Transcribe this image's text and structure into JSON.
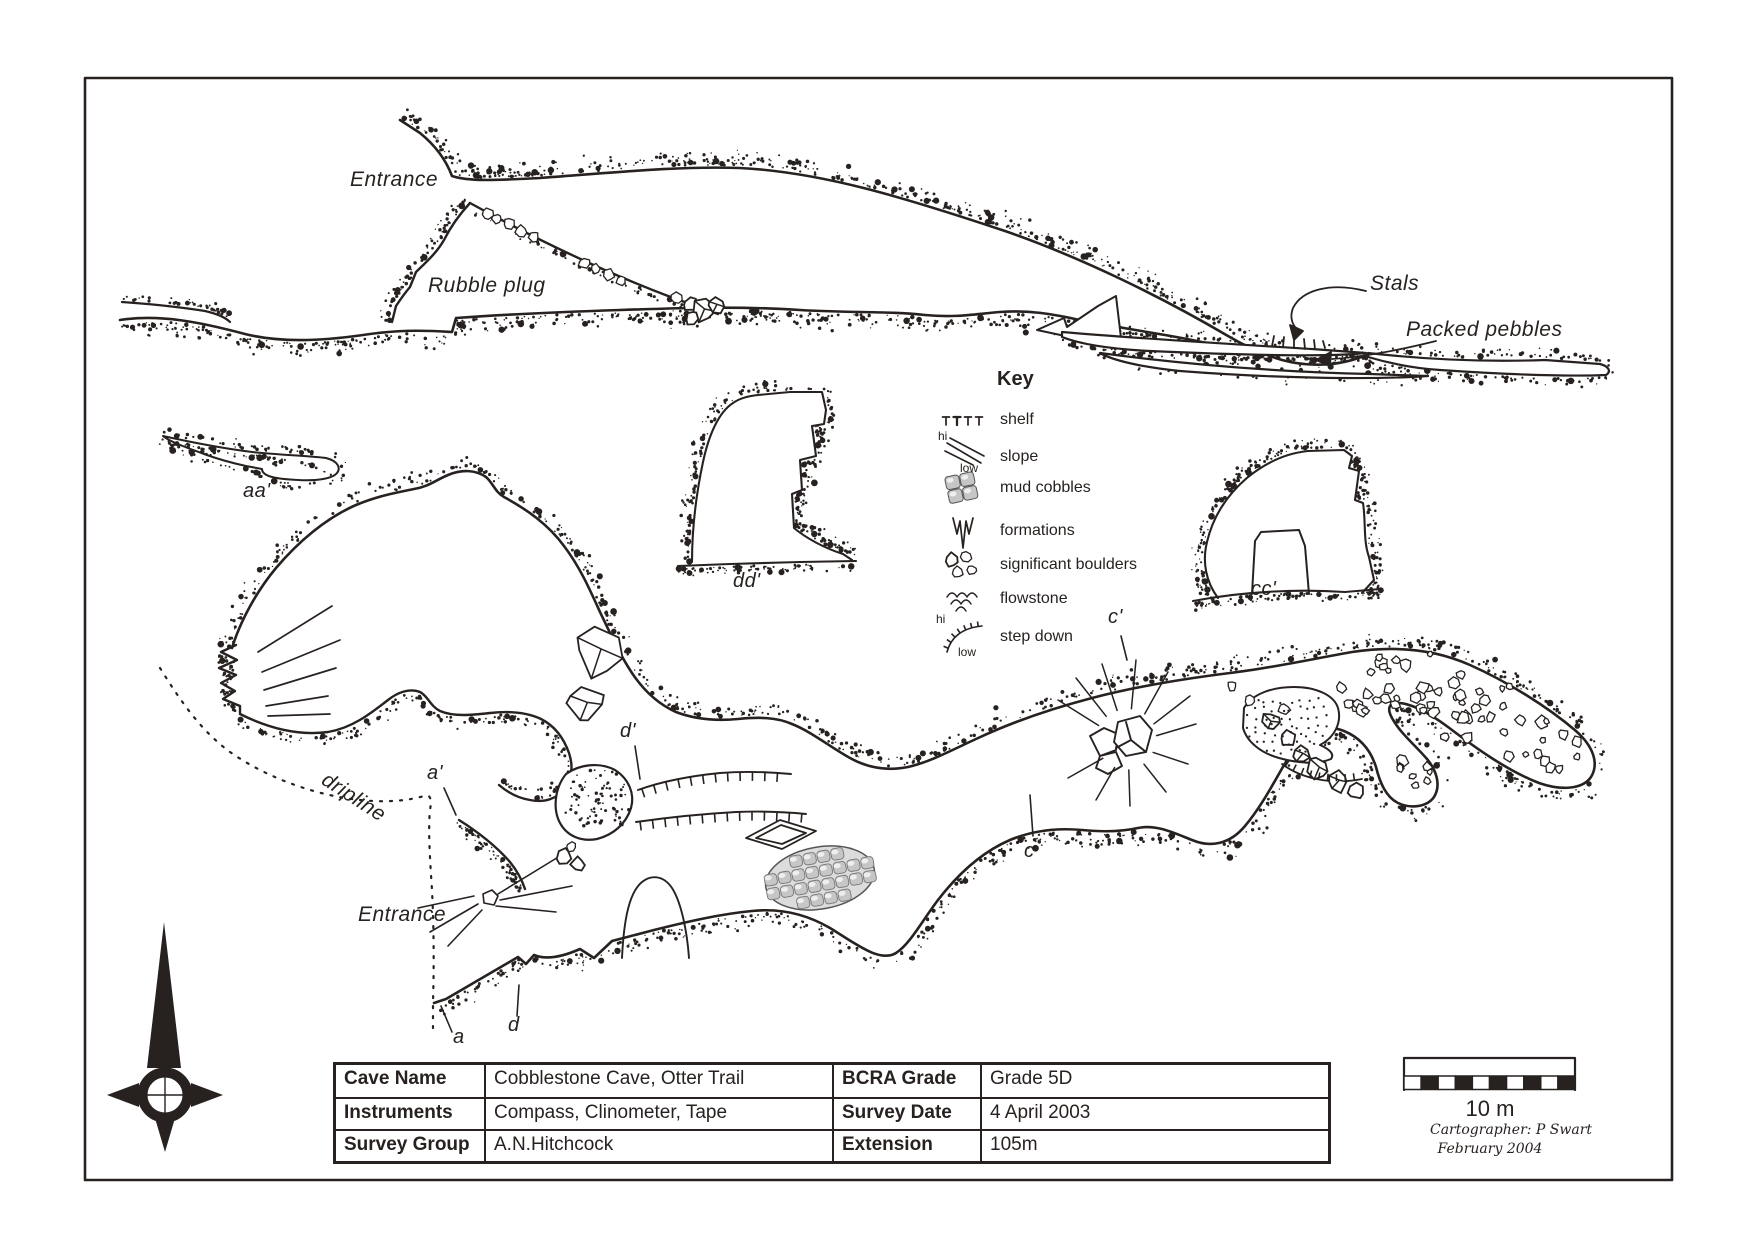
{
  "map_labels": {
    "entrance_top": "Entrance",
    "rubble_plug": "Rubble plug",
    "stals": "Stals",
    "packed_pebbles": "Packed pebbles",
    "section_aa": "aa'",
    "section_dd": "dd'",
    "section_cc": "cc'",
    "c_prime": "c'",
    "c": "c",
    "d_prime": "d'",
    "d": "d",
    "a_prime": "a'",
    "a": "a",
    "dripline": "dripline",
    "entrance_bottom": "Entrance"
  },
  "key": {
    "title": "Key",
    "hi": "hi",
    "low": "low",
    "items": [
      {
        "icon": "shelf-icon",
        "label": "shelf"
      },
      {
        "icon": "slope-icon",
        "label": "slope"
      },
      {
        "icon": "mud-cobbles-icon",
        "label": "mud cobbles"
      },
      {
        "icon": "formations-icon",
        "label": "formations"
      },
      {
        "icon": "significant-boulders-icon",
        "label": "significant boulders"
      },
      {
        "icon": "flowstone-icon",
        "label": "flowstone"
      },
      {
        "icon": "step-down-icon",
        "label": "step down"
      }
    ]
  },
  "table": {
    "rows": [
      {
        "h1": "Cave Name",
        "v1": "Cobblestone Cave, Otter Trail",
        "h2": "BCRA Grade",
        "v2": "Grade 5D"
      },
      {
        "h1": "Instruments",
        "v1": "Compass, Clinometer, Tape",
        "h2": "Survey Date",
        "v2": "4 April 2003"
      },
      {
        "h1": "Survey Group",
        "v1": "A.N.Hitchcock",
        "h2": "Extension",
        "v2": "105m"
      }
    ]
  },
  "scale_bar": {
    "label": "10 m"
  },
  "credits": {
    "line1": "Cartographer: P Swart",
    "line2": "February 2004"
  },
  "colors": {
    "ink": "#272220",
    "paper": "#ffffff",
    "cobble_shade": "#c6c6c6"
  }
}
